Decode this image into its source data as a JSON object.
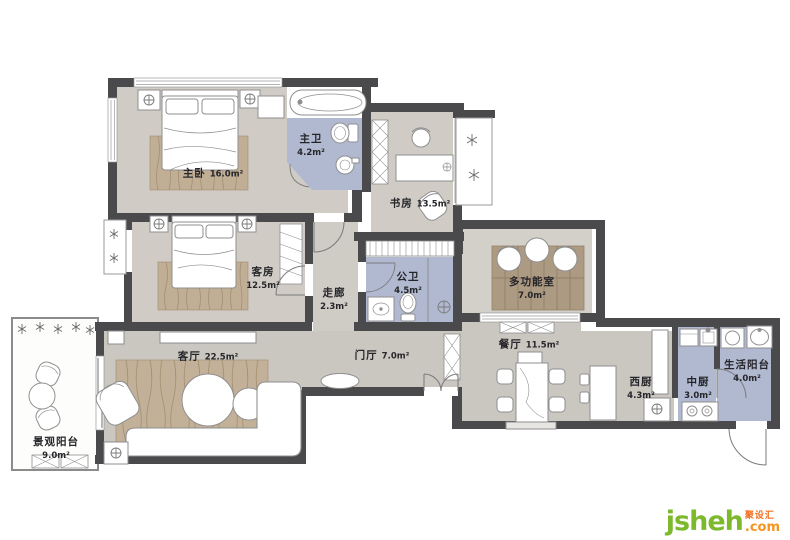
{
  "plan_title": "apartment-floor-plan",
  "rooms": [
    {
      "name": "主卧",
      "area": "16.0m²"
    },
    {
      "name": "主卫",
      "area": "4.2m²"
    },
    {
      "name": "书房",
      "area": "13.5m²"
    },
    {
      "name": "客房",
      "area": "12.5m²"
    },
    {
      "name": "走廊",
      "area": "2.3m²"
    },
    {
      "name": "公卫",
      "area": "4.5m²"
    },
    {
      "name": "多功能室",
      "area": "7.0m²"
    },
    {
      "name": "客厅",
      "area": "22.5m²"
    },
    {
      "name": "门厅",
      "area": "7.0m²"
    },
    {
      "name": "餐厅",
      "area": "11.5m²"
    },
    {
      "name": "西厨",
      "area": "4.3m²"
    },
    {
      "name": "中厨",
      "area": "3.0m²"
    },
    {
      "name": "生活阳台",
      "area": "4.0m²"
    },
    {
      "name": "景观阳台",
      "area": "9.0m²"
    }
  ],
  "watermark": {
    "brand": "jsheh",
    "suffix": ".com",
    "cjk": "聚设汇"
  },
  "colors": {
    "wall": "#4a4a4d",
    "bedroom_floor": "#d0ccc5",
    "living_floor": "#cac6c0",
    "wet_area_blue": "#b1b9d1",
    "wood_rug": "#c0ae95",
    "wood_floor": "#ac9a82",
    "brand_green": "#7cb92c",
    "brand_orange": "#f7941d"
  }
}
